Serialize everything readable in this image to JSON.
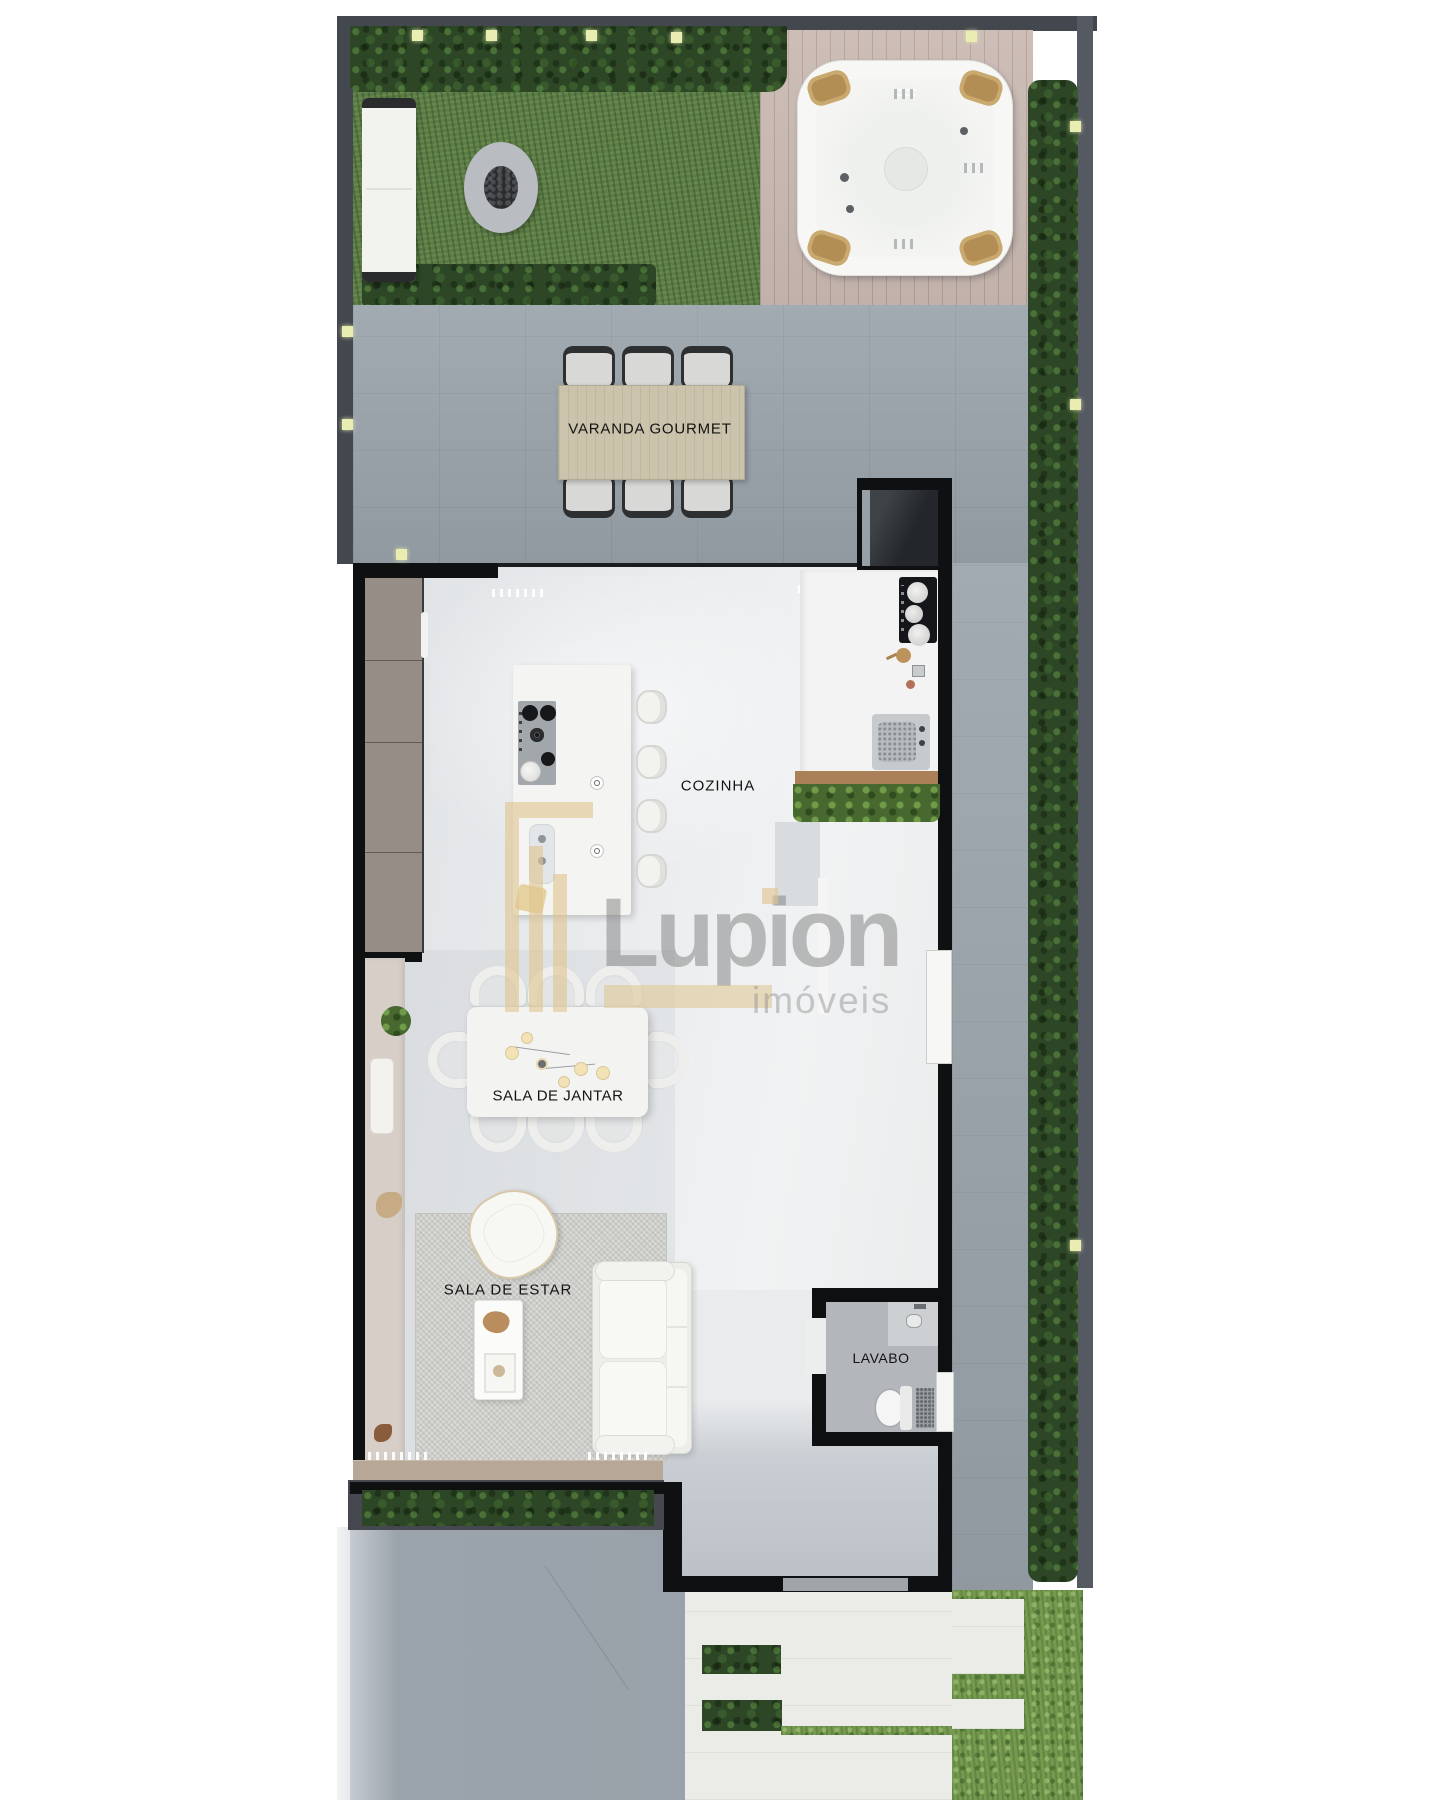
{
  "plan": {
    "rooms": {
      "varanda_gourmet": "VARANDA GOURMET",
      "cozinha": "COZINHA",
      "sala_de_jantar": "SALA DE JANTAR",
      "sala_de_estar": "SALA DE ESTAR",
      "lavabo": "LAVABO"
    },
    "watermark": {
      "brand": "Lupion",
      "tagline": "imóveis"
    },
    "colors": {
      "boundary_wall": "#43474e",
      "house_wall": "#0f1012",
      "grass": "#5b7b47",
      "bright_grass": "#74994f",
      "hedge": "#2c4626",
      "concrete_patio": "#98a1a9",
      "wood_deck": "#c8b8b1",
      "interior_floor": "#e9ebed",
      "varanda_table_wood": "#cbc3ac",
      "wall_light": "#e9edb2",
      "watermark_gold": "#dec590",
      "watermark_gray": "#8a8a8a"
    }
  }
}
